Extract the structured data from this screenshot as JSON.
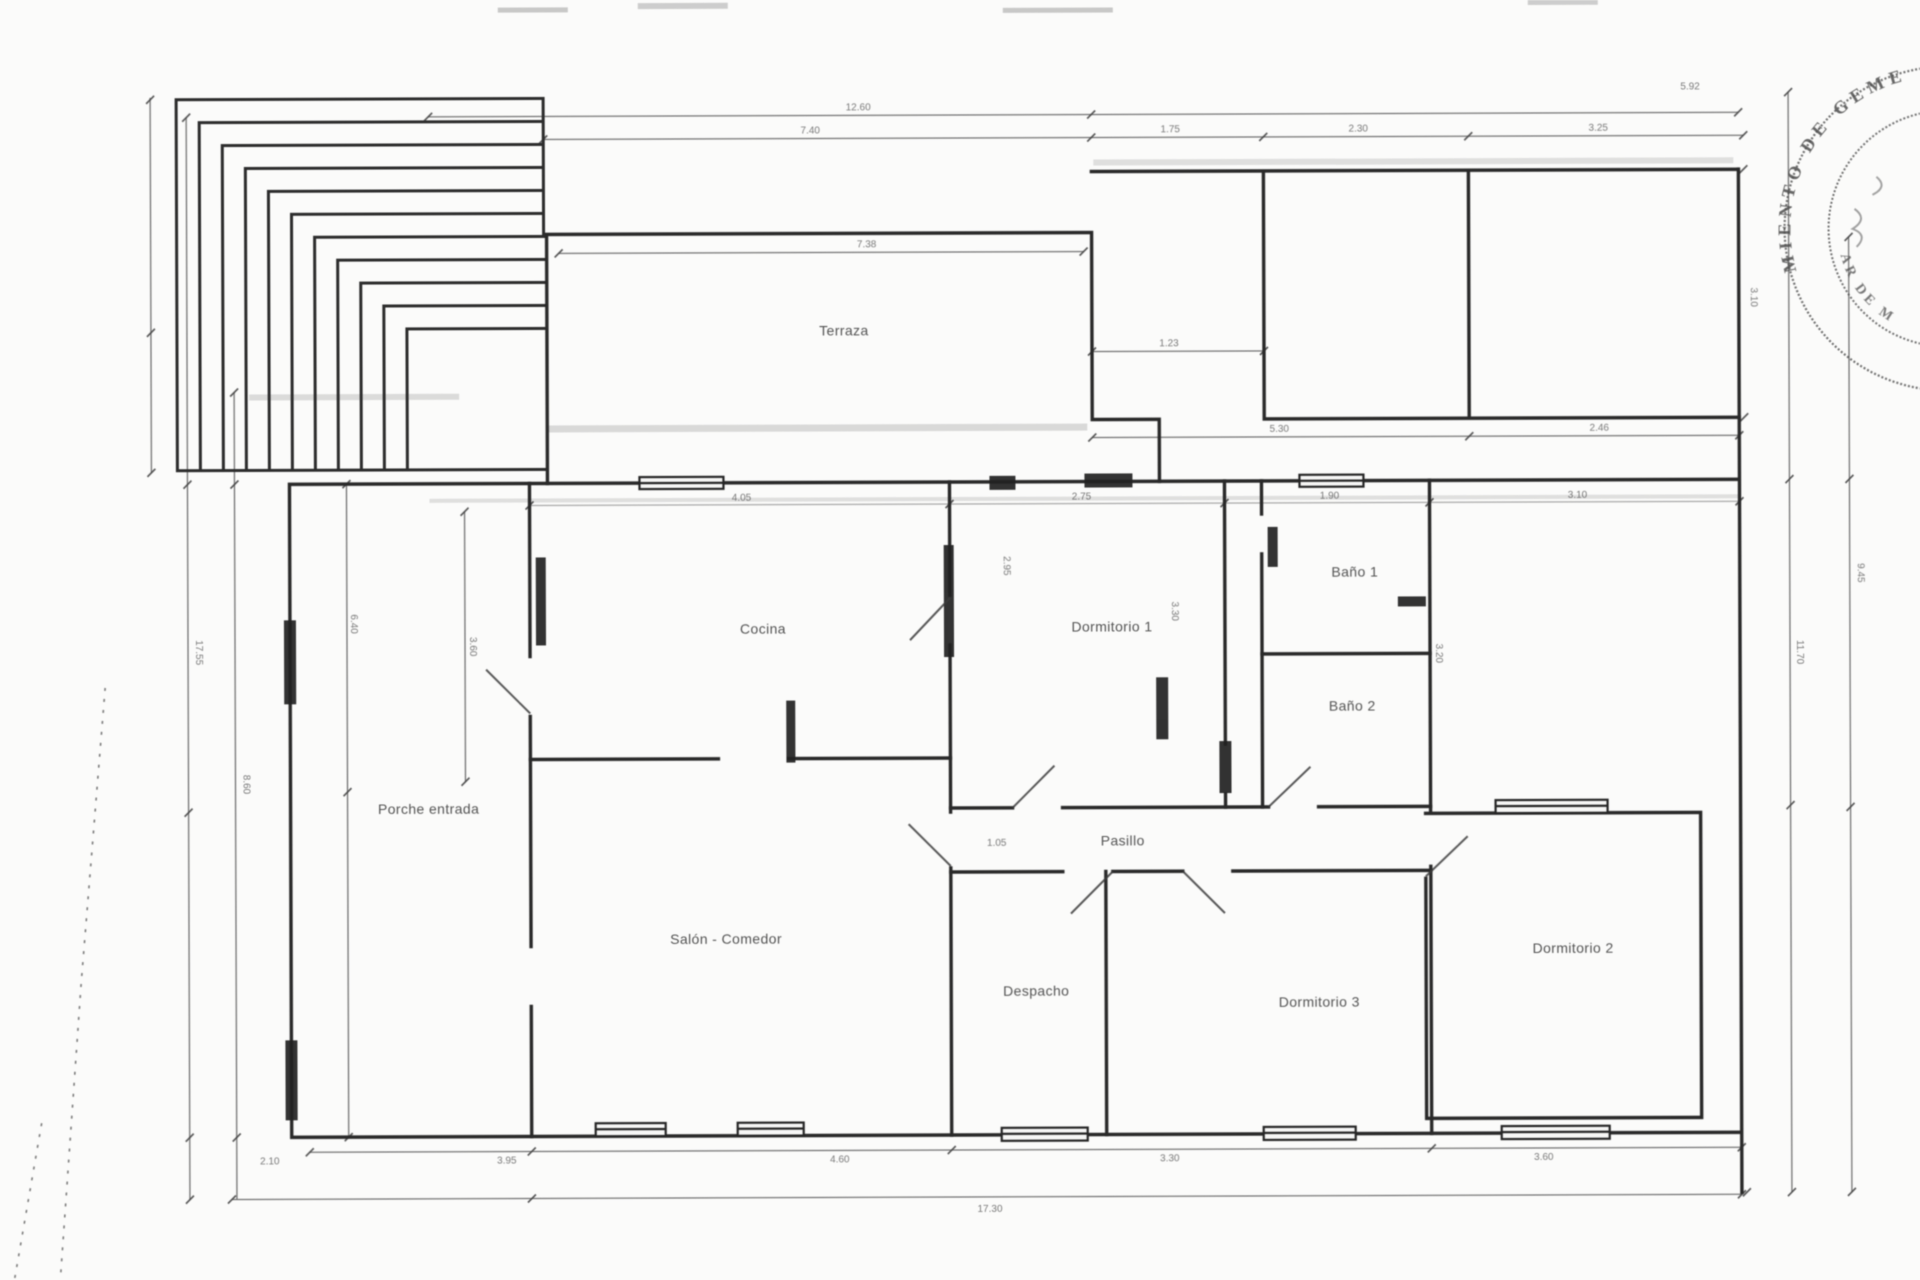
{
  "document": {
    "type": "scanned architectural floor plan",
    "language": "es"
  },
  "rooms": {
    "terraza": {
      "label": "Terraza"
    },
    "cocina": {
      "label": "Cocina"
    },
    "dormitorio1": {
      "label": "Dormitorio 1"
    },
    "bano1": {
      "label": "Baño 1"
    },
    "bano2": {
      "label": "Baño 2"
    },
    "porche": {
      "label": "Porche entrada"
    },
    "salon": {
      "label": "Salón - Comedor"
    },
    "pasillo": {
      "label": "Pasillo"
    },
    "despacho": {
      "label": "Despacho"
    },
    "dormitorio3": {
      "label": "Dormitorio 3"
    },
    "dormitorio2": {
      "label": "Dormitorio 2"
    }
  },
  "dims": [
    {
      "t": "12.60",
      "x": 860,
      "y": 110,
      "r": 0
    },
    {
      "t": "5.92",
      "x": 1692,
      "y": 92,
      "r": 0
    },
    {
      "t": "7.40",
      "x": 812,
      "y": 133,
      "r": 0
    },
    {
      "t": "1.75",
      "x": 1172,
      "y": 133,
      "r": 0
    },
    {
      "t": "2.30",
      "x": 1360,
      "y": 133,
      "r": 0
    },
    {
      "t": "3.25",
      "x": 1600,
      "y": 133,
      "r": 0
    },
    {
      "t": "7.38",
      "x": 868,
      "y": 247,
      "r": 0
    },
    {
      "t": "1.23",
      "x": 1170,
      "y": 347,
      "r": 0
    },
    {
      "t": "5.30",
      "x": 1280,
      "y": 433,
      "r": 0
    },
    {
      "t": "2.46",
      "x": 1600,
      "y": 433,
      "r": 0
    },
    {
      "t": "4.05",
      "x": 742,
      "y": 500,
      "r": 0
    },
    {
      "t": "2.75",
      "x": 1082,
      "y": 500,
      "r": 0
    },
    {
      "t": "1.90",
      "x": 1330,
      "y": 500,
      "r": 0
    },
    {
      "t": "3.10",
      "x": 1578,
      "y": 500,
      "r": 0
    },
    {
      "t": "17.55",
      "x": 196,
      "y": 650,
      "r": 90
    },
    {
      "t": "8.60",
      "x": 243,
      "y": 782,
      "r": 90
    },
    {
      "t": "6.40",
      "x": 351,
      "y": 622,
      "r": 90
    },
    {
      "t": "3.60",
      "x": 470,
      "y": 645,
      "r": 90
    },
    {
      "t": "2.95",
      "x": 1004,
      "y": 566,
      "r": 90
    },
    {
      "t": "3.30",
      "x": 1172,
      "y": 612,
      "r": 90
    },
    {
      "t": "3.20",
      "x": 1436,
      "y": 655,
      "r": 90
    },
    {
      "t": "3.10",
      "x": 1752,
      "y": 300,
      "r": 90
    },
    {
      "t": "11.70",
      "x": 1797,
      "y": 655,
      "r": 90
    },
    {
      "t": "9.45",
      "x": 1858,
      "y": 576,
      "r": 90
    },
    {
      "t": "1.05",
      "x": 996,
      "y": 846,
      "r": 0
    },
    {
      "t": "2.10",
      "x": 268,
      "y": 1162,
      "r": 0
    },
    {
      "t": "3.95",
      "x": 505,
      "y": 1162,
      "r": 0
    },
    {
      "t": "4.60",
      "x": 838,
      "y": 1162,
      "r": 0
    },
    {
      "t": "3.30",
      "x": 1168,
      "y": 1162,
      "r": 0
    },
    {
      "t": "3.60",
      "x": 1542,
      "y": 1162,
      "r": 0
    },
    {
      "t": "17.30",
      "x": 988,
      "y": 1212,
      "r": 0
    }
  ],
  "stamp": {
    "outer_text_fragment": "MIENTO DE GEME",
    "inner_text_fragment": "AR DE M"
  },
  "colors": {
    "paper": "#fbfbfa",
    "ink": "#2a2a2a",
    "dim_line": "#585858",
    "label": "#3a3a3a",
    "stamp": "#4c4c4c"
  }
}
